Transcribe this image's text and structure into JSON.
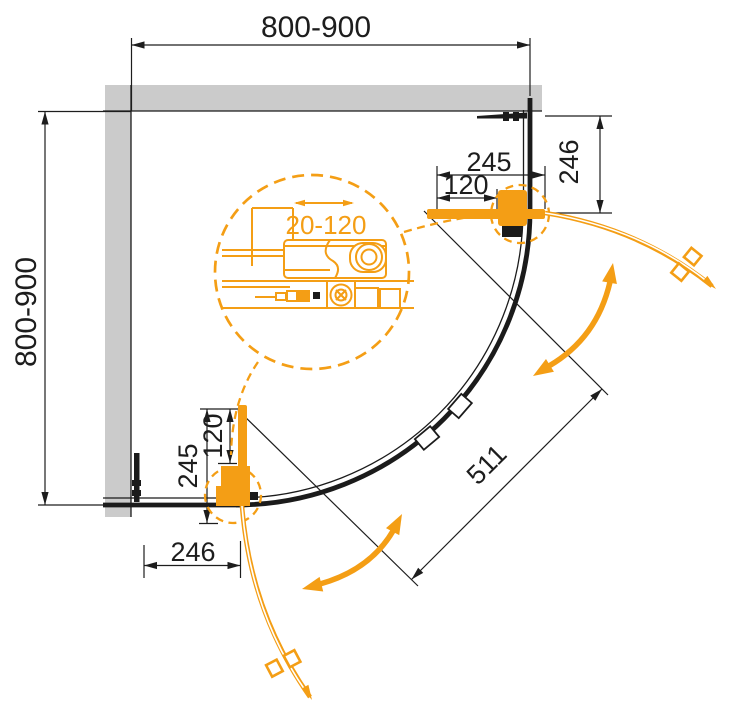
{
  "drawing": {
    "labels": {
      "width_top": "800-900",
      "depth_left": "800-900",
      "tr_width": "245",
      "tr_inner": "120",
      "tr_height": "246",
      "bl_height": "245",
      "bl_inner": "120",
      "bl_width": "246",
      "diagonal_opening": "511",
      "adjustment_range": "20-120"
    },
    "colors": {
      "accent": "#F49E15",
      "line": "#1D1D1D",
      "wall": "#CBCBCB"
    }
  }
}
